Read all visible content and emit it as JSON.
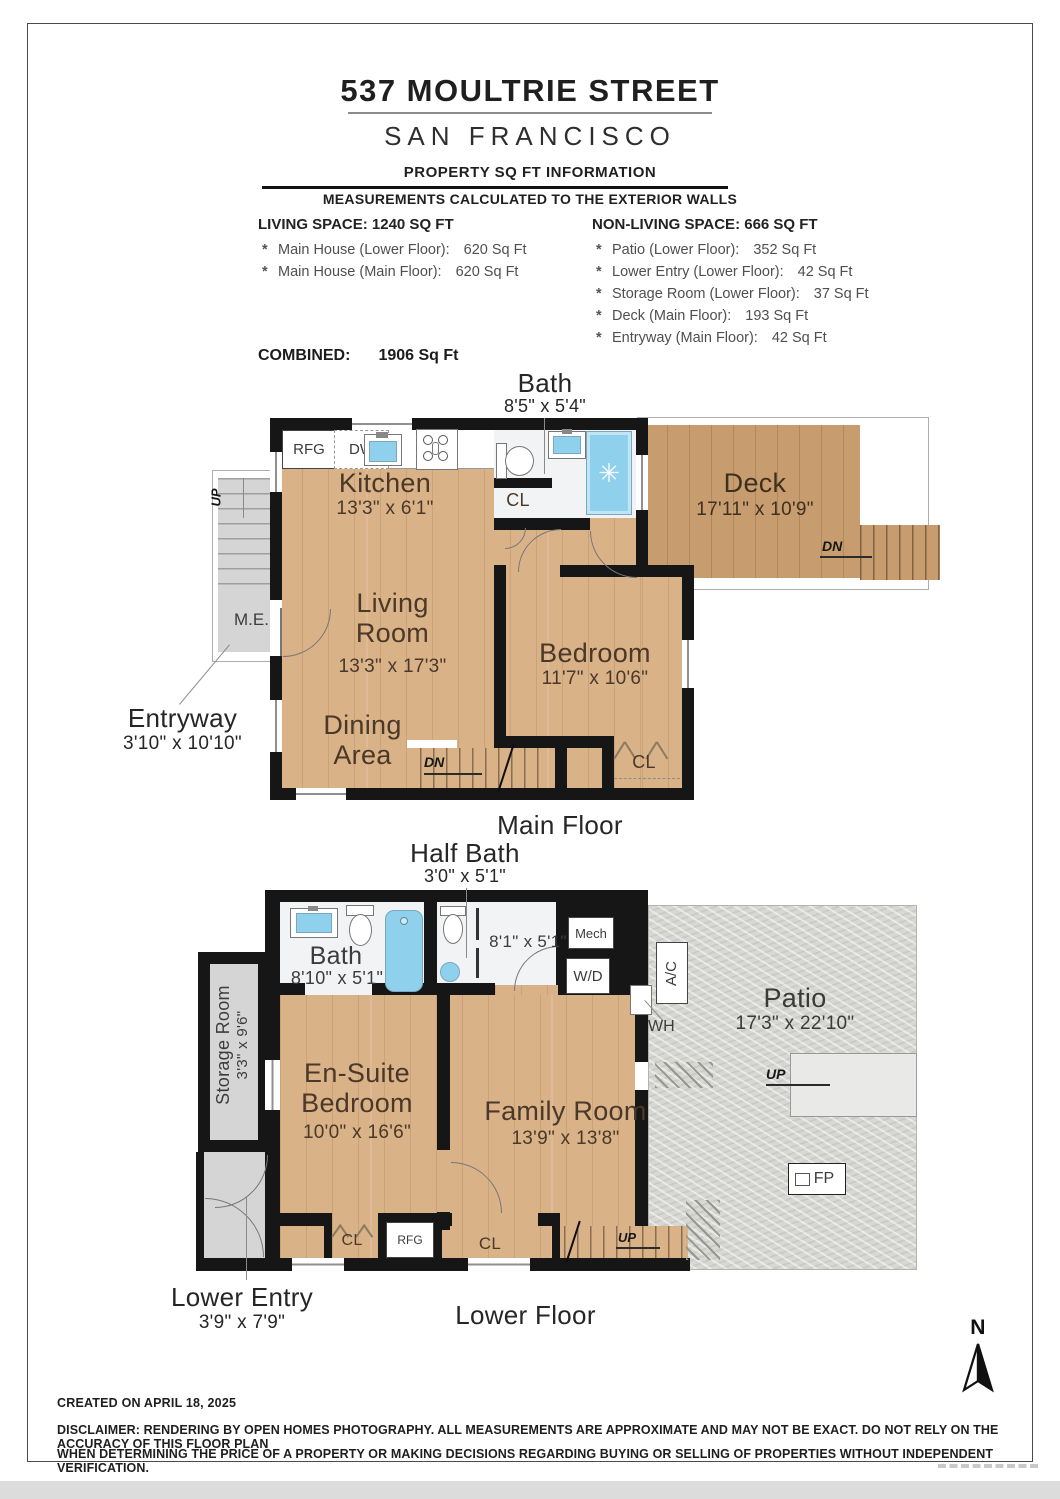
{
  "header": {
    "title": "537 MOULTRIE STREET",
    "city": "SAN FRANCISCO",
    "section": "PROPERTY SQ FT INFORMATION",
    "note": "MEASUREMENTS CALCULATED TO THE EXTERIOR WALLS"
  },
  "sqft": {
    "bullet": "*",
    "living": {
      "heading": "LIVING SPACE: 1240 SQ FT",
      "items": [
        {
          "label": "Main House (Lower Floor):",
          "value": "620 Sq Ft"
        },
        {
          "label": "Main House (Main Floor):",
          "value": "620 Sq Ft"
        }
      ]
    },
    "non_living": {
      "heading": "NON-LIVING SPACE: 666 SQ FT",
      "items": [
        {
          "label": "Patio (Lower Floor):",
          "value": "352 Sq Ft"
        },
        {
          "label": "Lower Entry (Lower Floor):",
          "value": "42 Sq Ft"
        },
        {
          "label": "Storage Room (Lower Floor):",
          "value": "37 Sq Ft"
        },
        {
          "label": "Deck (Main Floor):",
          "value": "193 Sq Ft"
        },
        {
          "label": "Entryway (Main Floor):",
          "value": "42 Sq Ft"
        }
      ]
    },
    "combined_label": "COMBINED:",
    "combined_value": "1906  Sq Ft"
  },
  "main_floor": {
    "floor_label": "Main Floor",
    "bath": {
      "name": "Bath",
      "dims": "8'5\" x 5'4\""
    },
    "kitchen": {
      "name": "Kitchen",
      "dims": "13'3\" x 6'1\""
    },
    "deck": {
      "name": "Deck",
      "dims": "17'11\" x 10'9\""
    },
    "living_room": {
      "line1": "Living",
      "line2": "Room",
      "dims": "13'3\" x 17'3\""
    },
    "dining": {
      "line1": "Dining",
      "line2": "Area"
    },
    "bedroom": {
      "name": "Bedroom",
      "dims": "11'7\" x 10'6\""
    },
    "entryway": {
      "name": "Entryway",
      "dims": "3'10\" x 10'10\""
    }
  },
  "lower_floor": {
    "floor_label": "Lower Floor",
    "half_bath": {
      "name": "Half Bath",
      "dims": "3'0\" x 5'1\""
    },
    "bath": {
      "name": "Bath",
      "dims": "8'10\" x 5'1\""
    },
    "laundry_dims": "8'1\" x 5'1\"",
    "ensuite": {
      "line1": "En-Suite",
      "line2": "Bedroom",
      "dims": "10'0\" x 16'6\""
    },
    "family_room": {
      "name": "Family Room",
      "dims": "13'9\" x 13'8\""
    },
    "patio": {
      "name": "Patio",
      "dims": "17'3\" x 22'10\""
    },
    "storage": {
      "name": "Storage Room",
      "dims": "3'3\" x 9'6\""
    },
    "lower_entry": {
      "name": "Lower Entry",
      "dims": "3'9\" x 7'9\""
    }
  },
  "glyphs": {
    "rfg": "RFG",
    "dw": "DW",
    "cl": "CL",
    "dn": "DN",
    "up": "UP",
    "me": "M.E.",
    "mech": "Mech",
    "wd": "W/D",
    "wh": "WH",
    "ac": "A/C",
    "fp": "FP",
    "north": "N"
  },
  "footer": {
    "created": "CREATED ON APRIL 18, 2025",
    "disclaimer1": "DISCLAIMER: RENDERING BY OPEN HOMES PHOTOGRAPHY. ALL MEASUREMENTS ARE APPROXIMATE AND MAY NOT BE EXACT. DO NOT RELY ON THE ACCURACY OF THIS FLOOR PLAN",
    "disclaimer2": "WHEN DETERMINING THE PRICE OF A PROPERTY OR MAKING DECISIONS REGARDING BUYING OR SELLING OF PROPERTIES WITHOUT INDEPENDENT VERIFICATION."
  },
  "colors": {
    "wall": "#161616",
    "wood": "#d9b288",
    "deck_wood": "#c79d6f",
    "patio": "#d7d8d4",
    "fixture_blue": "#8fd0ec",
    "stairs_gray": "#d5d5d5"
  }
}
